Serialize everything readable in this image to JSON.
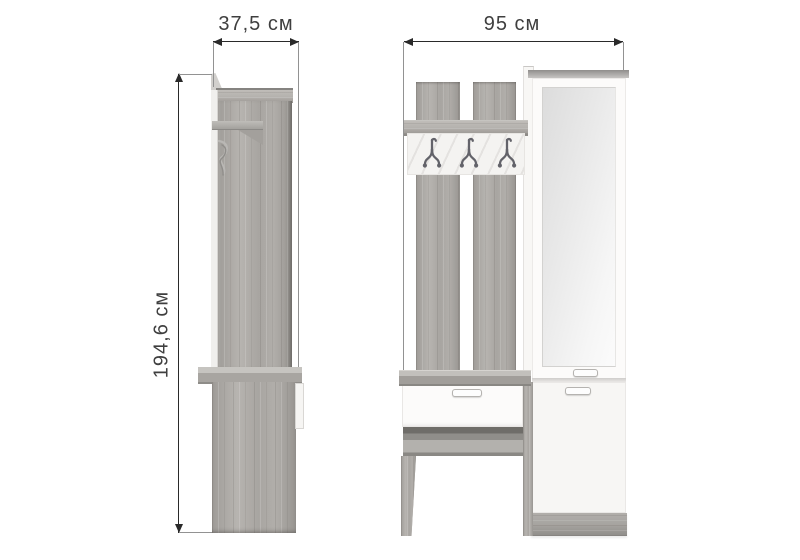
{
  "labels": {
    "side_width": "37,5 см",
    "front_width": "95 см",
    "height": "194,6 см"
  },
  "colors": {
    "background": "#ffffff",
    "dimension_line": "#2a2a2a",
    "label_text": "#3f3f3f",
    "wood_base": "#aaa7a3",
    "panel_white": "#fcfbfa",
    "hook_metal": "#63636a",
    "mirror_light": "#f6f6f6",
    "mirror_dark": "#dcdcdc"
  },
  "icons": {
    "coat_hook": "coat-hook-icon",
    "hook_profile": "hook-profile-icon",
    "arrowheads": [
      "arrowhead-left-icon",
      "arrowhead-right-icon",
      "arrowhead-up-icon",
      "arrowhead-down-icon"
    ]
  }
}
